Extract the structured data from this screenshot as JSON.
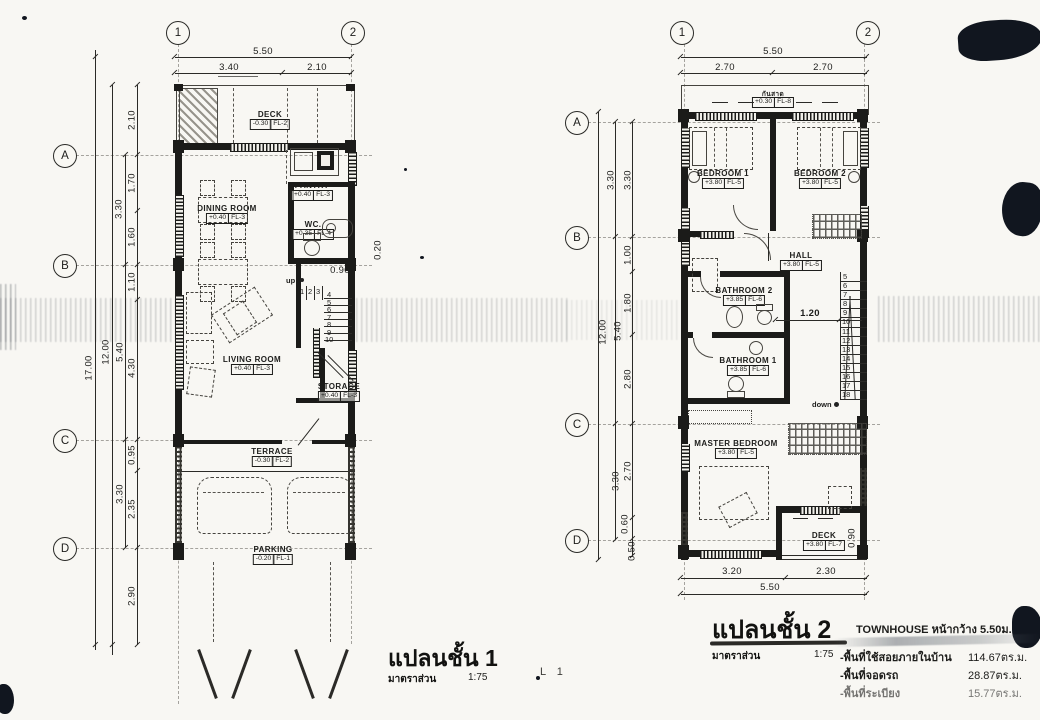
{
  "colors": {
    "paper": "#f8f7f3",
    "ink": "#1d1d1b",
    "artifact": "#11161f",
    "smudge": "#9aa0a6"
  },
  "sheet_note": "L 1",
  "plan1": {
    "caption": "แปลนชั้น 1",
    "scale_label": "มาตราส่วน",
    "scale_value": "1:75",
    "grid_cols": [
      "1",
      "2"
    ],
    "grid_rows": [
      "A",
      "B",
      "C",
      "D"
    ],
    "top_dims": {
      "overall": "5.50",
      "left": "3.40",
      "right": "2.10"
    },
    "side_dims": {
      "overall": "17.00",
      "building": "12.00",
      "bays": [
        "3.30",
        "5.40",
        "3.30"
      ],
      "chain": [
        "2.10",
        "1.70",
        "1.60",
        "1.10",
        "4.30",
        "0.95",
        "2.35",
        "2.90"
      ]
    },
    "rooms": {
      "deck": {
        "name": "DECK",
        "level": "-0.30",
        "fl": "FL-2"
      },
      "pantry": {
        "name": "PANTRY",
        "level": "+0.40",
        "fl": "FL-3"
      },
      "dining": {
        "name": "DINING ROOM",
        "level": "+0.40",
        "fl": "FL-3"
      },
      "wc": {
        "name": "WC.",
        "level": "+0.35",
        "fl": "FL-4"
      },
      "living": {
        "name": "LIVING ROOM",
        "level": "+0.40",
        "fl": "FL-3"
      },
      "storage": {
        "name": "STORAGE",
        "level": "+0.40",
        "fl": "FL-3"
      },
      "terrace": {
        "name": "TERRACE",
        "level": "-0.30",
        "fl": "FL-2"
      },
      "parking": {
        "name": "PARKING",
        "level": "-0.20",
        "fl": "FL-1"
      }
    },
    "stair": {
      "direction": "up",
      "width_dim": "0.90",
      "door_dim": "0.20",
      "treads": [
        "1",
        "2",
        "3",
        "4",
        "5",
        "6",
        "7",
        "8",
        "9",
        "10"
      ]
    }
  },
  "plan2": {
    "caption": "แปลนชั้น 2",
    "scale_label": "มาตราส่วน",
    "scale_value": "1:75",
    "grid_cols": [
      "1",
      "2"
    ],
    "grid_rows": [
      "A",
      "B",
      "C",
      "D"
    ],
    "top_dims": {
      "overall": "5.50",
      "left": "2.70",
      "right": "2.70"
    },
    "bottom_dims": {
      "left": "3.20",
      "right": "2.30",
      "overall": "5.50"
    },
    "side_dims": {
      "building": "12.00",
      "bays": [
        "3.30",
        "5.40",
        "3.30"
      ],
      "chain": [
        "3.30",
        "1.00",
        "1.80",
        "2.80",
        "2.70",
        "0.60",
        "0.50"
      ]
    },
    "rooms": {
      "canopy": {
        "name": "กันสาด",
        "level": "+0.30",
        "fl": "FL-8"
      },
      "bedroom1": {
        "name": "BEDROOM 1",
        "level": "+3.80",
        "fl": "FL-5"
      },
      "bedroom2": {
        "name": "BEDROOM 2",
        "level": "+3.80",
        "fl": "FL-5"
      },
      "hall": {
        "name": "HALL",
        "level": "+3.80",
        "fl": "FL-5"
      },
      "bathroom2": {
        "name": "BATHROOM 2",
        "level": "+3.85",
        "fl": "FL-6"
      },
      "bathroom1": {
        "name": "BATHROOM 1",
        "level": "+3.85",
        "fl": "FL-6"
      },
      "master": {
        "name": "MASTER BEDROOM",
        "level": "+3.80",
        "fl": "FL-5"
      },
      "deck": {
        "name": "DECK",
        "level": "+3.80",
        "fl": "FL-7"
      }
    },
    "stair": {
      "direction": "down",
      "hall_dim": "1.20",
      "deck_dim": "0.90",
      "treads": [
        "5",
        "6",
        "7",
        "8",
        "9",
        "10",
        "11",
        "12",
        "13",
        "14",
        "15",
        "16",
        "17",
        "18"
      ]
    }
  },
  "summary": {
    "title": "TOWNHOUSE หน้ากว้าง 5.50ม.",
    "rows": [
      {
        "label": "-พื้นที่ใช้สอยภายในบ้าน",
        "value": "114.67ตร.ม."
      },
      {
        "label": "-พื้นที่จอดรถ",
        "value": "28.87ตร.ม."
      },
      {
        "label": "-พื้นที่ระเบียง",
        "value": "15.77ตร.ม."
      }
    ]
  }
}
